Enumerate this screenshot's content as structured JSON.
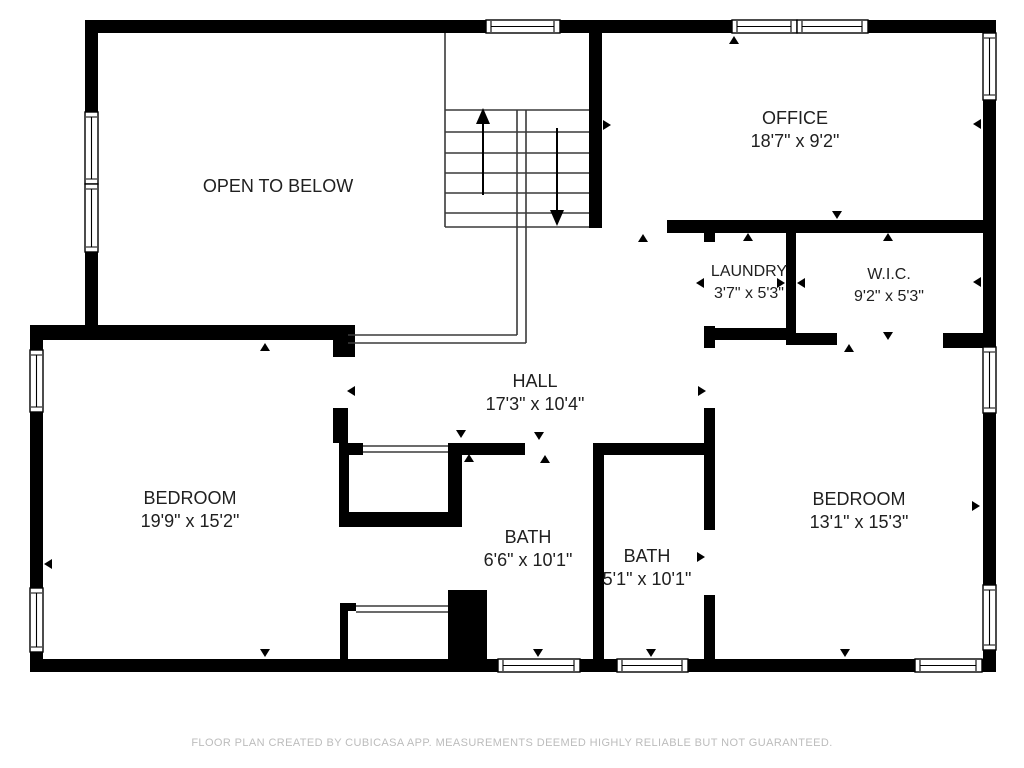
{
  "floorplan": {
    "rooms": [
      {
        "name": "OPEN TO BELOW",
        "dims": ""
      },
      {
        "name": "OFFICE",
        "dims": "18'7\" x 9'2\""
      },
      {
        "name": "LAUNDRY",
        "dims": "3'7\" x 5'3\""
      },
      {
        "name": "W.I.C.",
        "dims": "9'2\" x 5'3\""
      },
      {
        "name": "HALL",
        "dims": "17'3\" x 10'4\""
      },
      {
        "name": "BEDROOM",
        "dims": "19'9\" x 15'2\""
      },
      {
        "name": "BATH",
        "dims": "6'6\" x 10'1\""
      },
      {
        "name": "BATH",
        "dims": "5'1\" x 10'1\""
      },
      {
        "name": "BEDROOM",
        "dims": "13'1\" x 15'3\""
      }
    ],
    "footer": "FLOOR PLAN CREATED BY CUBICASA APP. MEASUREMENTS DEEMED HIGHLY RELIABLE BUT NOT GUARANTEED.",
    "colors": {
      "wall": "#000000",
      "background": "#ffffff",
      "label_text": "#202020",
      "footer_text": "#bcbcbc"
    }
  }
}
